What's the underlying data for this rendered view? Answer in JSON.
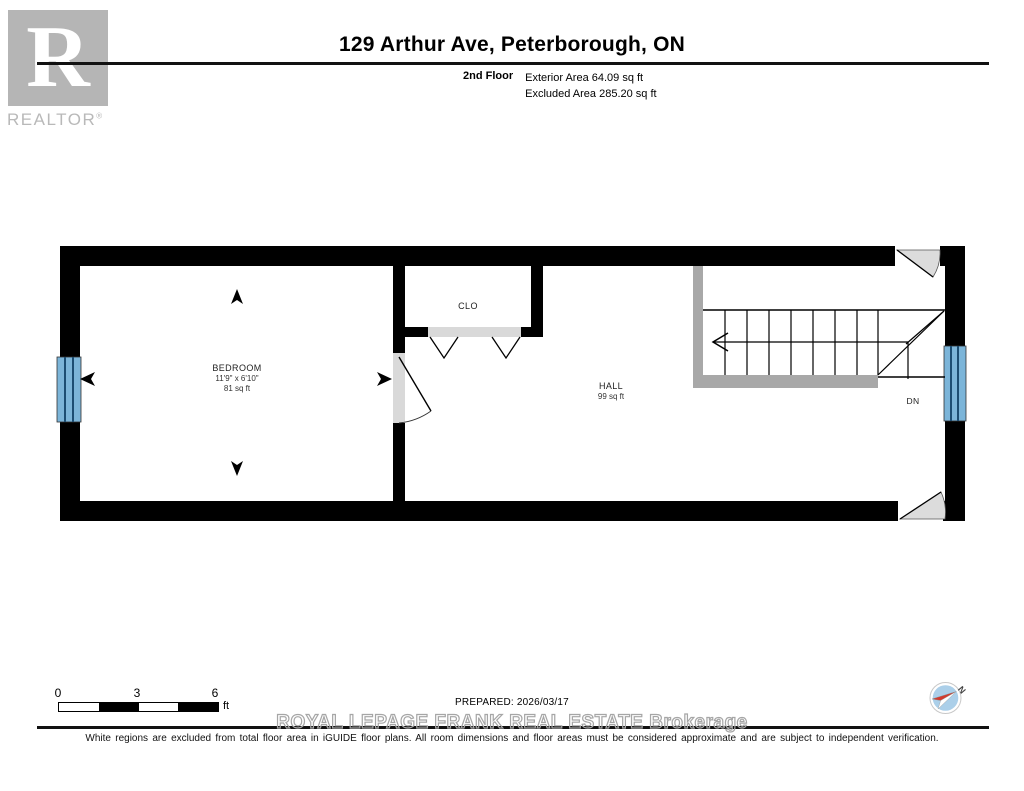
{
  "header": {
    "title": "129 Arthur Ave, Peterborough, ON",
    "floor_label": "2nd Floor",
    "exterior_area": "Exterior Area 64.09 sq ft",
    "excluded_area": "Excluded Area 285.20 sq ft"
  },
  "branding": {
    "logo_letter": "R",
    "logo_text": "REALTOR",
    "registered_mark": "®"
  },
  "plan": {
    "rooms": [
      {
        "name": "BEDROOM",
        "dimensions": "11'9\" x 6'10\"",
        "area": "81 sq ft"
      },
      {
        "name": "CLO"
      },
      {
        "name": "HALL",
        "area": "99 sq ft"
      }
    ],
    "stairs_label": "DN"
  },
  "footer": {
    "scale": {
      "ticks": [
        "0",
        "3",
        "6"
      ],
      "unit": "ft"
    },
    "prepared": "PREPARED: 2026/03/17",
    "watermark": "ROYAL LEPAGE FRANK REAL ESTATE Brokerage",
    "compass_label": "N",
    "disclaimer": "White regions are excluded from total floor area in iGUIDE floor plans. All room dimensions and floor areas must be considered approximate and are subject to independent verification."
  },
  "colors": {
    "wall": "#000000",
    "window_blue": "#7cb5d9",
    "window_mullion": "#1d4e73",
    "railing_gray": "#a8a8a8",
    "door_gray": "#dcdcdc",
    "opening_gray": "#d9d9d9",
    "watermark_gray": "#a6a6a6",
    "logo_gray": "#b5b5b5",
    "compass_red": "#d23b2e",
    "compass_blue": "#abcfe9"
  }
}
